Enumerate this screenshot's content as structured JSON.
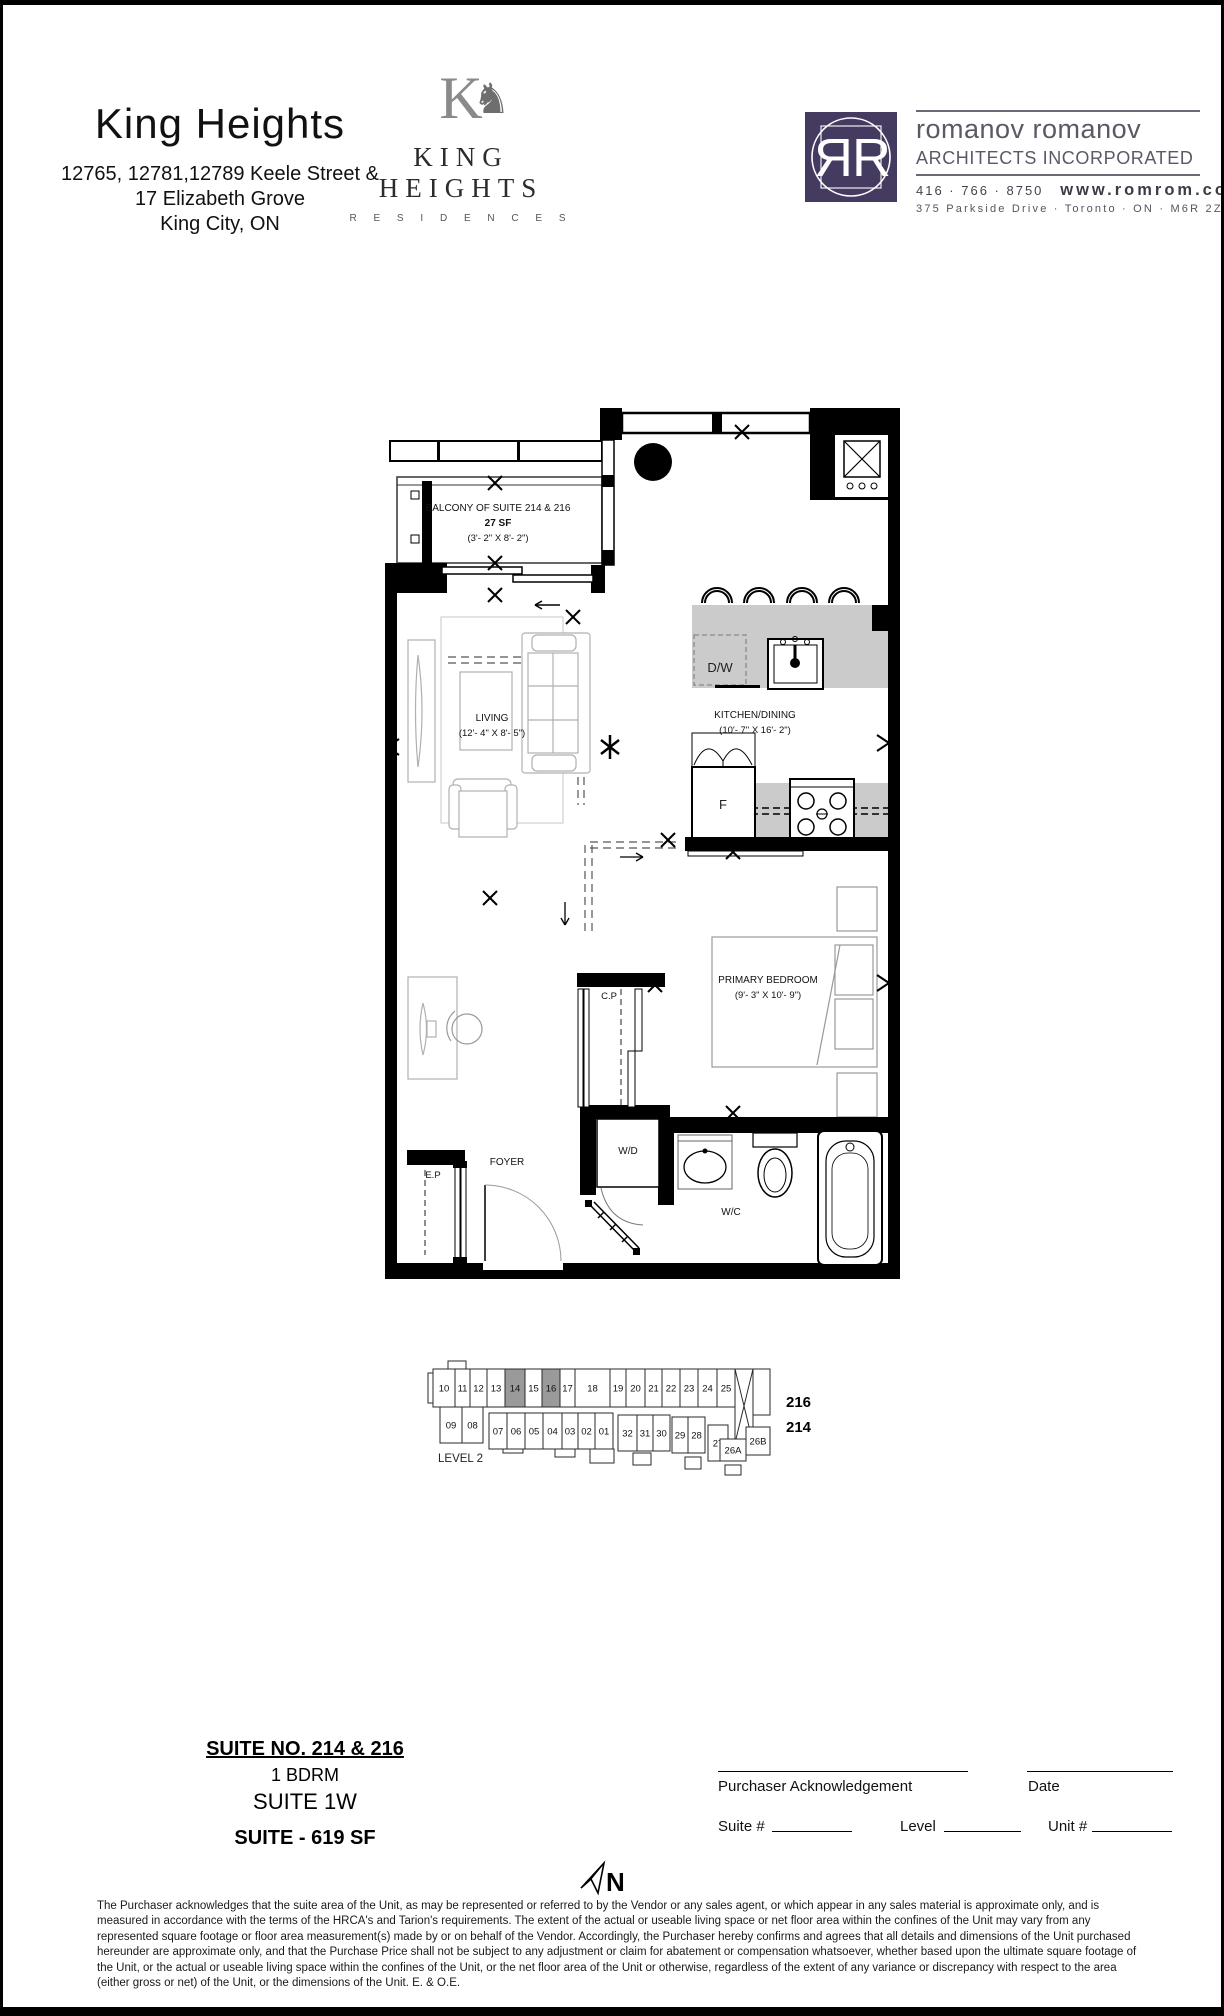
{
  "page": {
    "north_label": "N"
  },
  "header": {
    "title": "King Heights",
    "address_lines": [
      "12765, 12781,12789 Keele Street &",
      "17 Elizabeth Grove",
      "King City, ON"
    ],
    "brand": {
      "monogram_letter": "K",
      "horse_glyph": "♞",
      "name": "KING HEIGHTS",
      "subtitle": "R E S I D E N C E S"
    },
    "architect": {
      "firm_name": "romanov romanov",
      "firm_subtitle": "ARCHITECTS INCORPORATED",
      "phone": "416 · 766 · 8750",
      "website": "www.romrom.com",
      "address": "375 Parkside Drive  ·  Toronto  ·  ON  ·  M6R 2Z6",
      "logo_letters": "R",
      "brand_color": "#453a60"
    }
  },
  "floor_plan": {
    "balcony_title": "BALCONY OF SUITE 214 & 216",
    "balcony_area": "27 SF",
    "balcony_dims": "(3'- 2\" X 8'- 2\")",
    "living_name": "LIVING",
    "living_dims": "(12'- 4\" X 8'- 5\")",
    "kitchen_name": "KITCHEN/DINING",
    "kitchen_dims": "(10'- 7\" X 16'- 2\")",
    "bedroom_name": "PRIMARY BEDROOM",
    "bedroom_dims": "(9'- 3\" X 10'- 9\")",
    "labels": {
      "dishwasher": "D/W",
      "fridge": "F",
      "washer_dryer": "W/D",
      "closet": "C.P",
      "electrical_panel": "E.P",
      "foyer": "FOYER",
      "water_closet": "W/C"
    }
  },
  "keyplan": {
    "level_label": "LEVEL 2",
    "top_units": [
      "10",
      "11",
      "12",
      "13",
      "14",
      "15",
      "16",
      "17",
      "18",
      "19",
      "20",
      "21",
      "22",
      "23",
      "24",
      "25"
    ],
    "bottom_units": [
      "09",
      "08",
      "07",
      "06",
      "05",
      "04",
      "03",
      "02",
      "01",
      "32",
      "31",
      "30",
      "29",
      "28",
      "27",
      "26A",
      "26B"
    ],
    "highlighted_units": [
      "14",
      "16"
    ],
    "highlight_color": "#9a9a9a",
    "callout_units": [
      "216",
      "214"
    ]
  },
  "suite_info": {
    "suite_no": "SUITE NO. 214 & 216",
    "type": "1 BDRM",
    "suite_name": "SUITE 1W",
    "area": "SUITE - 619 SF"
  },
  "acknowledgement": {
    "purchaser_label": "Purchaser Acknowledgement",
    "date_label": "Date",
    "suite_field_label": "Suite #",
    "level_field_label": "Level",
    "unit_field_label": "Unit #"
  },
  "disclaimer": "The Purchaser acknowledges that the suite area of the Unit, as may be represented or referred to by the Vendor or any sales agent, or which appear in any sales material is approximate only, and is measured in accordance with the terms of the HRCA's and Tarion's requirements.  The extent of the actual or useable living space or net floor area within the confines of the Unit may vary from any represented square footage or floor area measurement(s) made by or on behalf of the Vendor. Accordingly, the Purchaser hereby confirms and agrees that all details and dimensions of the Unit purchased hereunder are approximate only, and that the Purchase Price shall not be subject to any adjustment or claim for abatement or compensation whatsoever, whether based upon the ultimate square footage of the Unit, or the actual or useable living space within the confines of the Unit, or the net floor area of the Unit or otherwise, regardless of the extent of any variance or discrepancy with respect to the area (either gross or net) of the Unit, or the dimensions of the Unit. E. & O.E."
}
